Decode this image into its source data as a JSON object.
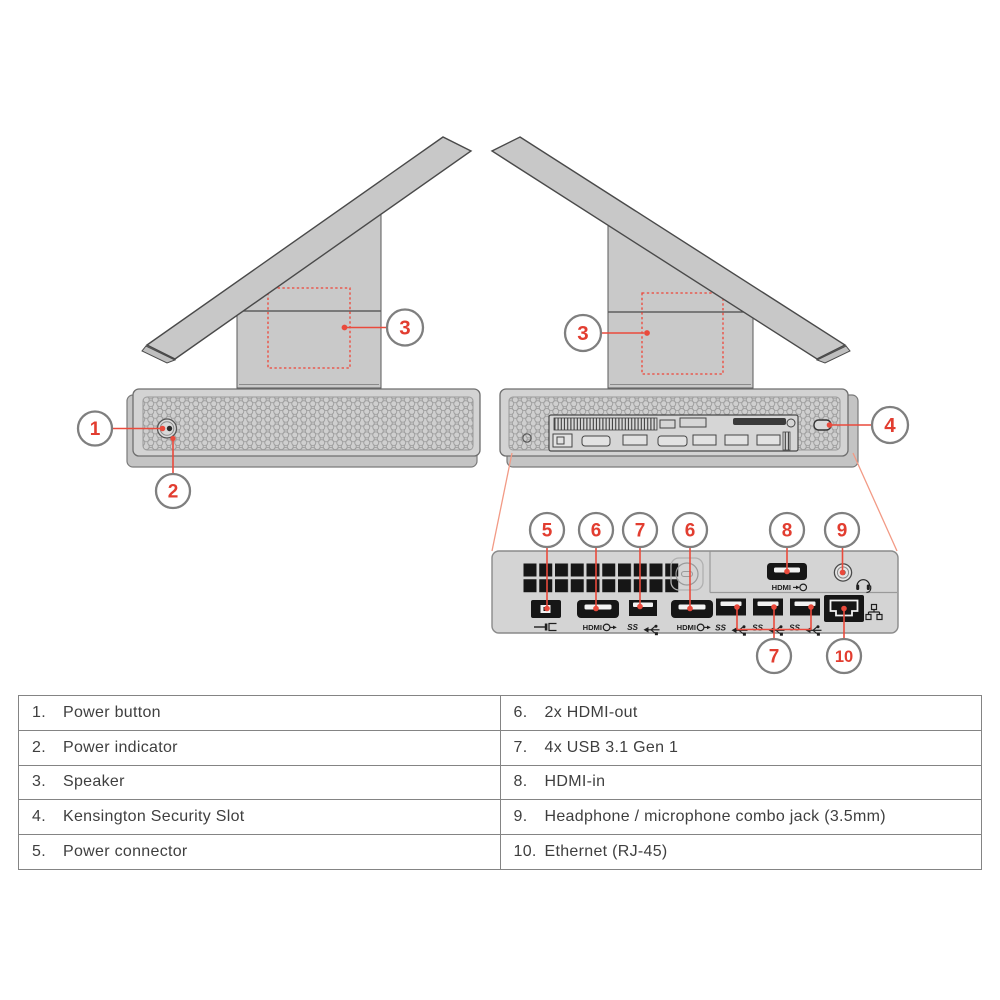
{
  "figure": {
    "title": "All-in-one computer front and rear views with numbered port callouts"
  },
  "colors": {
    "accent_red": "#e23d30",
    "leader_red": "#ea4a3c",
    "leader_salmon": "#f29a85",
    "callout_ring": "#7f7f7f",
    "device_gray": "#c9c9c9",
    "outline_gray": "#4a4a4a",
    "table_border": "#848484",
    "table_text": "#3f3f3f"
  },
  "callouts": [
    {
      "target": "power-button",
      "label": "1"
    },
    {
      "target": "power-indicator",
      "label": "2"
    },
    {
      "target": "speaker-front-view",
      "label": "3"
    },
    {
      "target": "speaker-rear-view",
      "label": "3"
    },
    {
      "target": "kensington-security-slot",
      "label": "4"
    },
    {
      "target": "power-connector",
      "label": "5"
    },
    {
      "target": "hdmi-out-1",
      "label": "6"
    },
    {
      "target": "usb-1",
      "label": "7"
    },
    {
      "target": "hdmi-out-2",
      "label": "6"
    },
    {
      "target": "hdmi-in",
      "label": "8"
    },
    {
      "target": "headphone-jack",
      "label": "9"
    },
    {
      "target": "usb-group",
      "label": "7"
    },
    {
      "target": "ethernet",
      "label": "10"
    }
  ],
  "port_labels": {
    "hdmi": "HDMI",
    "usb_ss": "SS"
  },
  "icons": {
    "dc_in": "dc-in-plug",
    "hdmi_out": "circle-arrow-out",
    "hdmi_in": "circle-arrow-in",
    "usb_ss": "usb-superspeed-trident",
    "headset": "headphone-with-mic",
    "ethernet": "network-nodes"
  },
  "legend_table": {
    "left": [
      {
        "num": "1.",
        "label": "Power button"
      },
      {
        "num": "2.",
        "label": "Power indicator"
      },
      {
        "num": "3.",
        "label": "Speaker"
      },
      {
        "num": "4.",
        "label": "Kensington Security Slot"
      },
      {
        "num": "5.",
        "label": "Power connector"
      }
    ],
    "right": [
      {
        "num": "6.",
        "label": "2x HDMI-out"
      },
      {
        "num": "7.",
        "label": "4x USB 3.1 Gen 1"
      },
      {
        "num": "8.",
        "label": "HDMI-in"
      },
      {
        "num": "9.",
        "label": "Headphone / microphone combo jack (3.5mm)"
      },
      {
        "num": "10.",
        "label": "Ethernet (RJ-45)"
      }
    ]
  }
}
